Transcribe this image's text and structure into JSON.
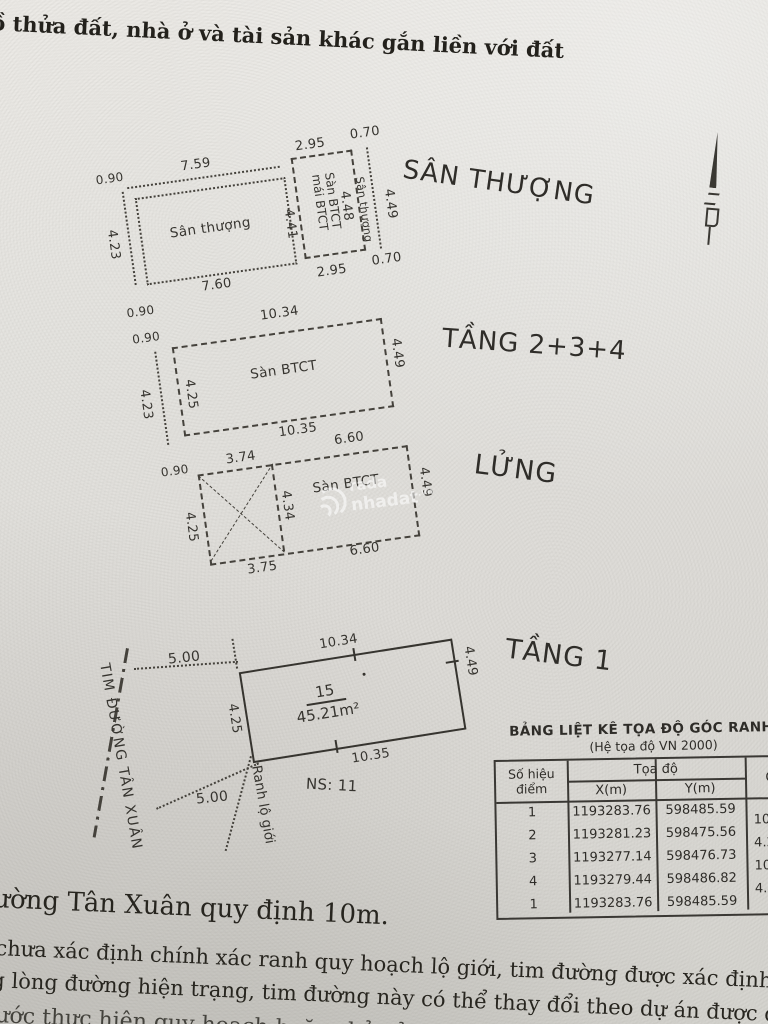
{
  "colors": {
    "ink": "#36342f",
    "paper": "#e2e1dd",
    "watermark_white": "#ffffff"
  },
  "doc": {
    "header_title": "ồ thửa đất, nhà ở và tài sản khác gắn liền với đất",
    "note_road": "ường Tân Xuân quy định 10m.",
    "note_line1": "chưa xác định chính xác ranh quy hoạch lộ giới, tim đường được xác định theo",
    "note_line2": "g lòng đường hiện trạng, tim đường này có thể thay đổi theo dự án được duyệt.",
    "note_line3": "ước thực hiện quy hoạch hoặc chủ sở hữu có yêu cầu"
  },
  "plans": {
    "plan1": {
      "label": "SÂN THƯỢNG",
      "room": "Sân thượng",
      "box_line1": "Sàn BTCT",
      "box_line2": "mái BTCT",
      "strip": "Sân thượng",
      "d_top1": "7.59",
      "d_top2": "2.95",
      "d_top3": "0.70",
      "d_bot1": "7.60",
      "d_bot2": "2.95",
      "d_bot3": "0.70",
      "d_left": "4.23",
      "d_mid": "4.41",
      "d_box": "4.48",
      "d_right": "4.49",
      "off_top": "0.90",
      "off_bot": "0.90"
    },
    "plan2": {
      "label": "TẦNG 2+3+4",
      "room": "Sàn BTCT",
      "d_top": "10.34",
      "d_bot": "10.35",
      "d_left_outer": "4.23",
      "d_left": "4.25",
      "d_right": "4.49",
      "off_top": "0.90"
    },
    "plan3": {
      "label": "LỬNG",
      "room": "Sàn BTCT",
      "d_top1": "3.74",
      "d_top2": "6.60",
      "d_bot1": "3.75",
      "d_bot2": "6.60",
      "d_left": "4.25",
      "d_mid": "4.34",
      "d_right": "4.49",
      "off_top": "0.90"
    },
    "plan4": {
      "label": "TẦNG 1",
      "lot": "15",
      "area": "45.21m²",
      "d_top": "10.34",
      "d_bot": "10.35",
      "d_left": "4.25",
      "d_right": "4.49",
      "road": "TIM ĐƯỜNG TÂN XUÂN",
      "d_road_top": "5.00",
      "d_road_bot": "5.00",
      "boundary": "Ranh lộ giới",
      "ns": "NS: 11"
    }
  },
  "table": {
    "title": "BẢNG LIỆT KÊ TỌA ĐỘ GÓC RANH",
    "subtitle": "(Hệ tọa độ VN 2000)",
    "col_point_1": "Số hiệu",
    "col_point_2": "điểm",
    "col_coords": "Tọa độ",
    "col_x": "X(m)",
    "col_y": "Y(m)",
    "col_edge": "C",
    "rows": [
      {
        "p": "1",
        "x": "1193283.76",
        "y": "598485.59"
      },
      {
        "p": "2",
        "x": "1193281.23",
        "y": "598475.56"
      },
      {
        "p": "3",
        "x": "1193277.14",
        "y": "598476.73"
      },
      {
        "p": "4",
        "x": "1193279.44",
        "y": "598486.82"
      },
      {
        "p": "1",
        "x": "1193283.76",
        "y": "598485.59"
      }
    ],
    "edges": [
      "10.34",
      "4.25",
      "10.35",
      "4.49"
    ]
  },
  "watermark": {
    "line1": "rada",
    "line2": "nhadat",
    "suffix": ".vn"
  }
}
